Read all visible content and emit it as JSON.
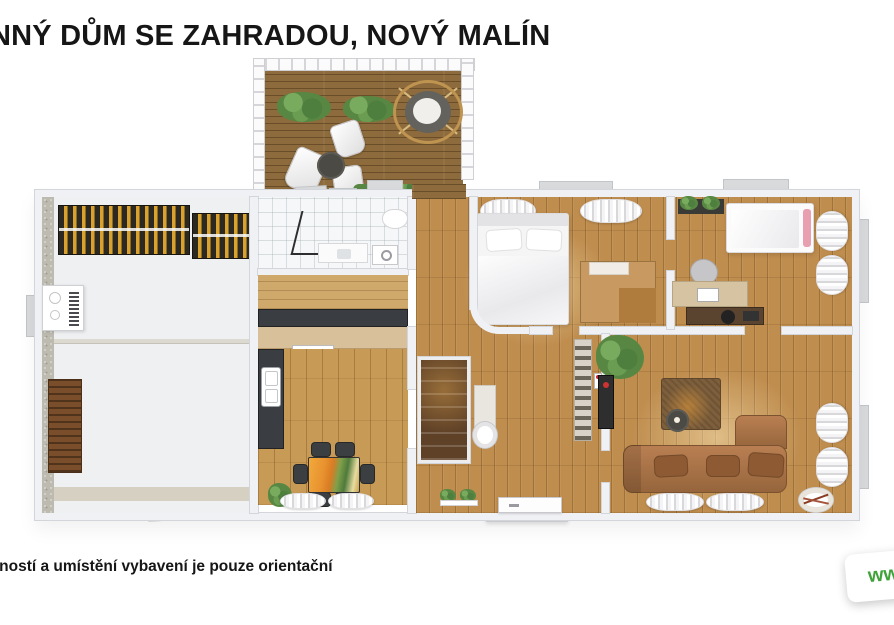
{
  "header": {
    "title": "NNÝ DŮM SE ZAHRADOU, NOVÝ MALÍN"
  },
  "footer": {
    "note": "tností a umístění vybavení je pouze orientační"
  },
  "watermark": {
    "text": "ww"
  },
  "palette": {
    "page_bg": "#ffffff",
    "title_color": "#161616",
    "wall_fill": "#f0f1f4",
    "wall_line": "#d2d6da",
    "wood_floor": "#bf8d4e",
    "wood_kitchen": "#c79a55",
    "wood_hall": "#cfa96b",
    "deck_wood": "#8d6b3c",
    "stair_wood": "#5f4127",
    "counter_dark": "#3a3e42",
    "cabinet_wood": "#d8c09a",
    "wardrobe_wood": "#c89a62",
    "garage_floor": "#eef0f2",
    "concrete": "#bdbab0",
    "woodpile_yellow": "#d9a22e",
    "woodpile_dark": "#2c2822",
    "rack_brown": "#7a4e2a",
    "sofa_brown": "#a9744a",
    "cushion_brown": "#8d5a33",
    "rug_brown": "#7d5f3c",
    "plant_green": "#588743",
    "watermark_green": "#3fa33a",
    "pink_accent": "#e8a0b0",
    "sill_gray": "#d9dadc"
  }
}
